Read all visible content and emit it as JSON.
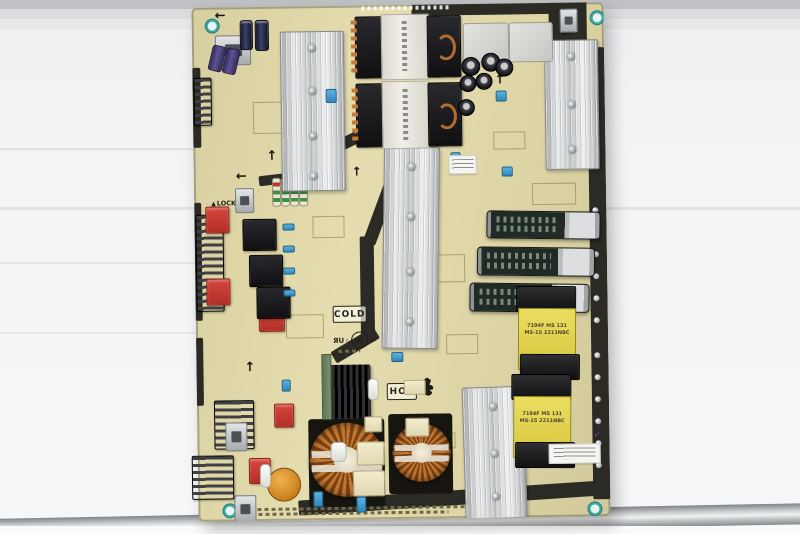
{
  "meta": {
    "subject": "Photograph of a TV switch-mode power supply circuit board lying on a light shelf"
  },
  "palette": {
    "pcb_tan": "#ded6a6",
    "slot_black": "#2b2a24",
    "heatsink_silver": "#ccd0d2",
    "copper_winding": "#b16c31",
    "transformer_yellow": "#e7d64f",
    "film_cap_red": "#c63a31",
    "electrolytic_green": "#232e28",
    "shelf_silver": "#c9cbcd",
    "screw_hole_teal": "#3ba8a4",
    "check_mark_purple": "#7b3fa4"
  },
  "board": {
    "labels": {
      "lock": "LOCK",
      "cold": "COLD",
      "hot": "HOT",
      "ur_mark": "ЯU",
      "ul_circle": "UL",
      "ul_c": "c",
      "ul_us": "us"
    },
    "yellow_transformers": [
      {
        "line1": "7194F MS 131",
        "line2": "MS-15 2211NBC"
      },
      {
        "line1": "7194F MS 131",
        "line2": "MS-15 2211NBC"
      }
    ]
  },
  "icons": {
    "arrow_up": "↑",
    "arrow_left": "←",
    "lock_arrow": "▲",
    "check_mark": "✓"
  }
}
